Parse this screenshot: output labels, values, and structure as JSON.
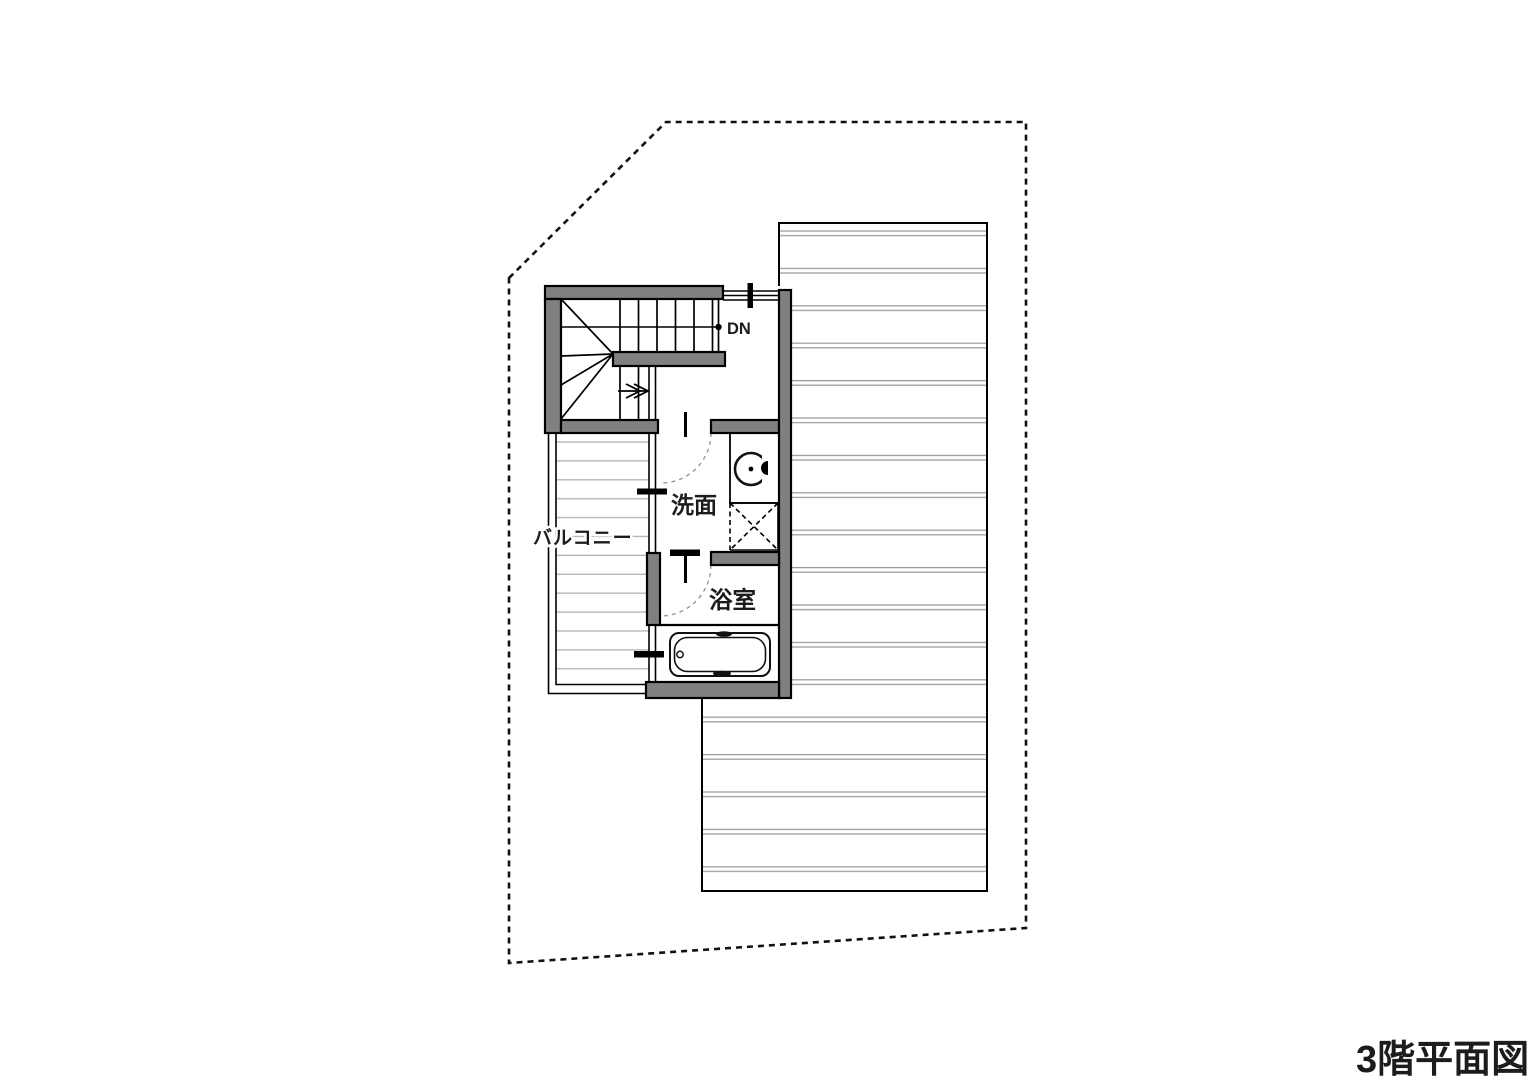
{
  "page": {
    "background": "#ffffff"
  },
  "title": {
    "text": "3階平面図"
  },
  "plan": {
    "labels": {
      "down": "DN",
      "washroom": "洗面",
      "bathroom": "浴室",
      "balcony": "バルコニー"
    },
    "colors": {
      "wall_fill": "#808080",
      "outline": "#000000",
      "roof_hatch_line": "#9a9a9a",
      "deck_hatch_line": "#b5b5b5",
      "door_swing": "#999999",
      "site_boundary": "#111111",
      "text": "#1c1c1c"
    }
  }
}
